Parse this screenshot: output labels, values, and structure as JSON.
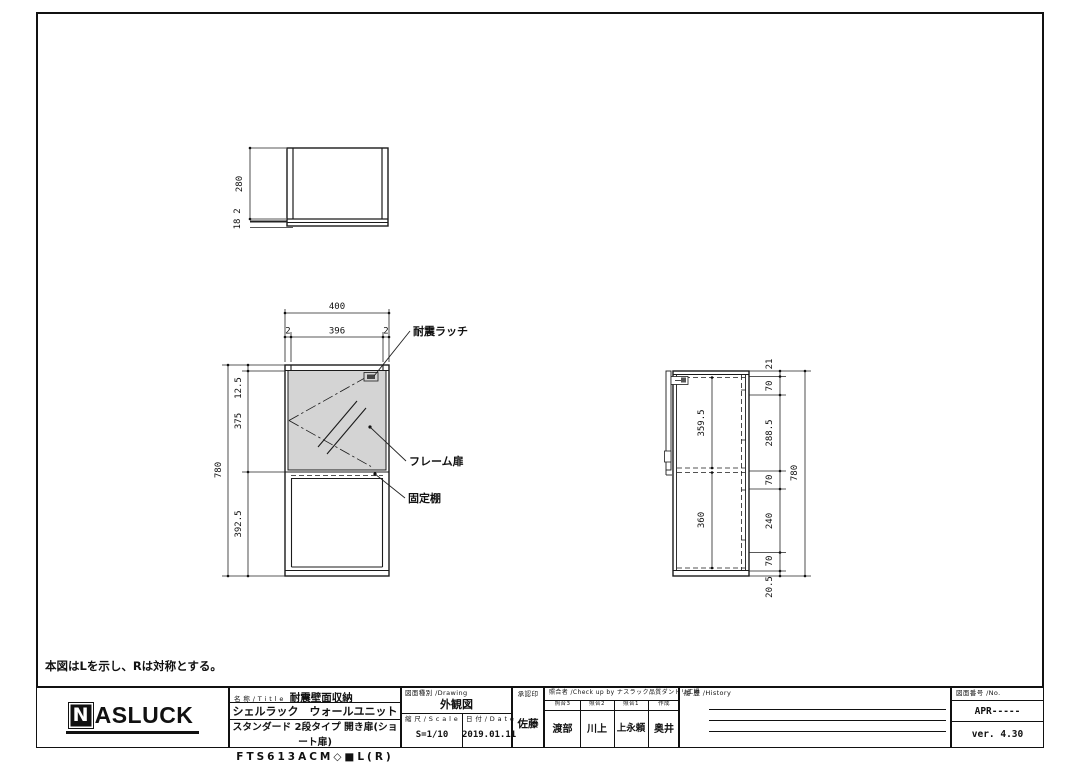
{
  "note": "本図はLを示し、Rは対称とする。",
  "views": {
    "top": {
      "height": "280",
      "dim_gap": "2",
      "dim_plate": "18"
    },
    "front": {
      "width": "400",
      "width_left": "2",
      "width_center": "396",
      "width_right": "2",
      "height": "780",
      "seg_top": "12.5",
      "seg_door": "375",
      "seg_bottom": "392.5",
      "label_latch": "耐震ラッチ",
      "label_door": "フレーム扉",
      "label_shelf": "固定棚"
    },
    "side": {
      "inner_top": "359.5",
      "inner_bottom": "360",
      "height": "780",
      "chain": [
        "21",
        "70",
        "288.5",
        "70",
        "240",
        "70",
        "20.5"
      ]
    }
  },
  "title_block": {
    "logo": {
      "n": "N",
      "rest": "ASLUCK"
    },
    "name": {
      "label": "名 称 / T i t l e",
      "value": "耐震壁面収納",
      "line2": "シェルラック　ウォールユニット",
      "line3": "スタンダード 2段タイプ 開き扉(ショート扉)",
      "line4": "FTS613ACM◇■L(R)"
    },
    "drawing": {
      "label": "図面種別 /Drawing",
      "value": "外観図",
      "scale_label": "縮 尺 / S c a l e",
      "scale_value": "S=1/10",
      "date_label": "日 付 / D a t e",
      "date_value": "2019.01.11"
    },
    "approval": {
      "label": "承認印",
      "name": "佐藤"
    },
    "check": {
      "label": "照合者 /Check up by ナスラック品質ダンドリ工場",
      "cols": [
        {
          "label": "照合3",
          "name": "渡部"
        },
        {
          "label": "照合2",
          "name": "川上"
        },
        {
          "label": "照合1",
          "name": "上永頼"
        },
        {
          "label": "作成",
          "name": "奥井"
        }
      ]
    },
    "history": {
      "label": "履 歴 /History"
    },
    "number": {
      "label": "図面番号 /No.",
      "value": "APR-----",
      "version": "ver. 4.30"
    }
  }
}
